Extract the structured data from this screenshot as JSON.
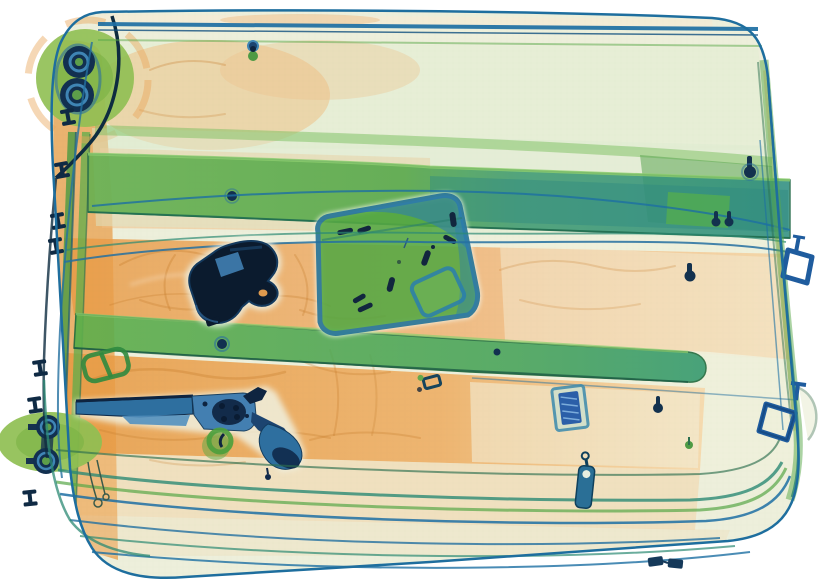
{
  "scene": {
    "label": "Airport security X-ray scan of a wheeled suitcase",
    "modality": "dual-energy x-ray (orange = organic, green = mixed, blue = metal)",
    "objects": {
      "suitcase": {
        "label": "suitcase shell with zipper piping and frame"
      },
      "pistol": {
        "label": "dark metallic semi-automatic pistol"
      },
      "revolver": {
        "label": "long-barrel revolver with grip lower right"
      },
      "ammo_box": {
        "label": "rectangular case containing loose cartridges",
        "cartridge_count": 8
      },
      "wheel_top_left": {
        "label": "suitcase wheel assembly, top left"
      },
      "wheel_bottom_left": {
        "label": "suitcase wheel assembly, bottom left"
      },
      "trolley_rails": {
        "label": "telescopic handle rails along left side"
      },
      "strap_upper": {
        "label": "upper internal packing strap"
      },
      "strap_lower": {
        "label": "lower internal packing strap"
      },
      "strap_buckle": {
        "label": "green strap adjuster buckle"
      },
      "d_ring_upper": {
        "label": "metal D-ring on right edge, upper"
      },
      "d_ring_lower": {
        "label": "metal D-ring on right edge, lower"
      },
      "zipper_tag": {
        "label": "metal zipper pull tag, bottom center"
      },
      "zipper_sliders": {
        "label": "pair of zipper sliders, bottom right"
      },
      "dense_item": {
        "label": "small dense rectangular item (battery-like)"
      },
      "rivets": {
        "label": "case rivets along edges",
        "count": 13
      }
    },
    "palette": {
      "background": "#ffffff",
      "shell_pale": "#edefdb",
      "organic_orange": "#efa755",
      "fabric_shadow": "#c87f2e",
      "strap_green": "#5fae4b",
      "soft_green": "#8fbf52",
      "box_green": "#57a843",
      "frame_teal": "#1d6fa3",
      "metal_blue": "#2e6f9f",
      "metal_dark": "#0b1b2e"
    }
  }
}
